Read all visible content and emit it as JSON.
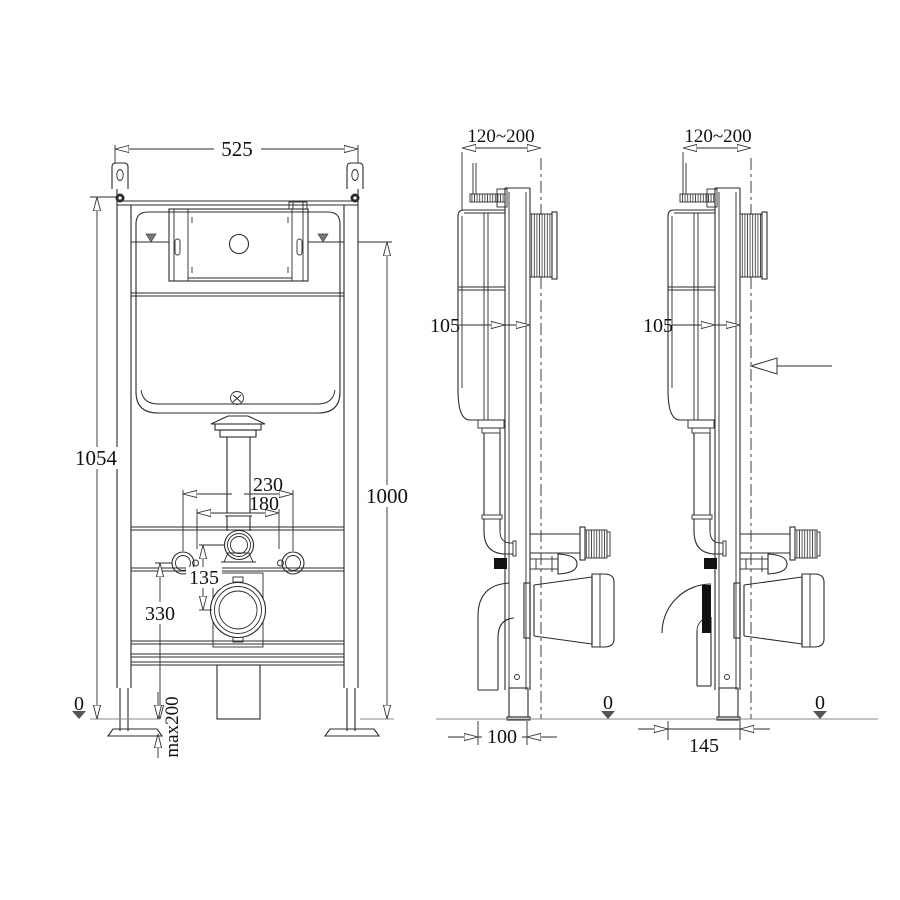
{
  "front": {
    "width": "525",
    "height_frame": "1054",
    "height_waterline": "1000",
    "bolt_spacing_outer": "230",
    "bolt_spacing_inner": "180",
    "flush_to_outlet": "135",
    "outlet_height": "330",
    "floor_level": "0",
    "adjustable_feet": "max200"
  },
  "side_100": {
    "install_depth": "120~200",
    "frame_depth": "105",
    "floor_level": "0",
    "foot_offset": "100"
  },
  "side_145": {
    "install_depth": "120~200",
    "frame_depth": "105",
    "floor_level": "0",
    "foot_offset": "145"
  },
  "colors": {
    "line": "#2b2b2b",
    "floor_line": "#8a8a8a",
    "marker_fill": "#666666"
  }
}
